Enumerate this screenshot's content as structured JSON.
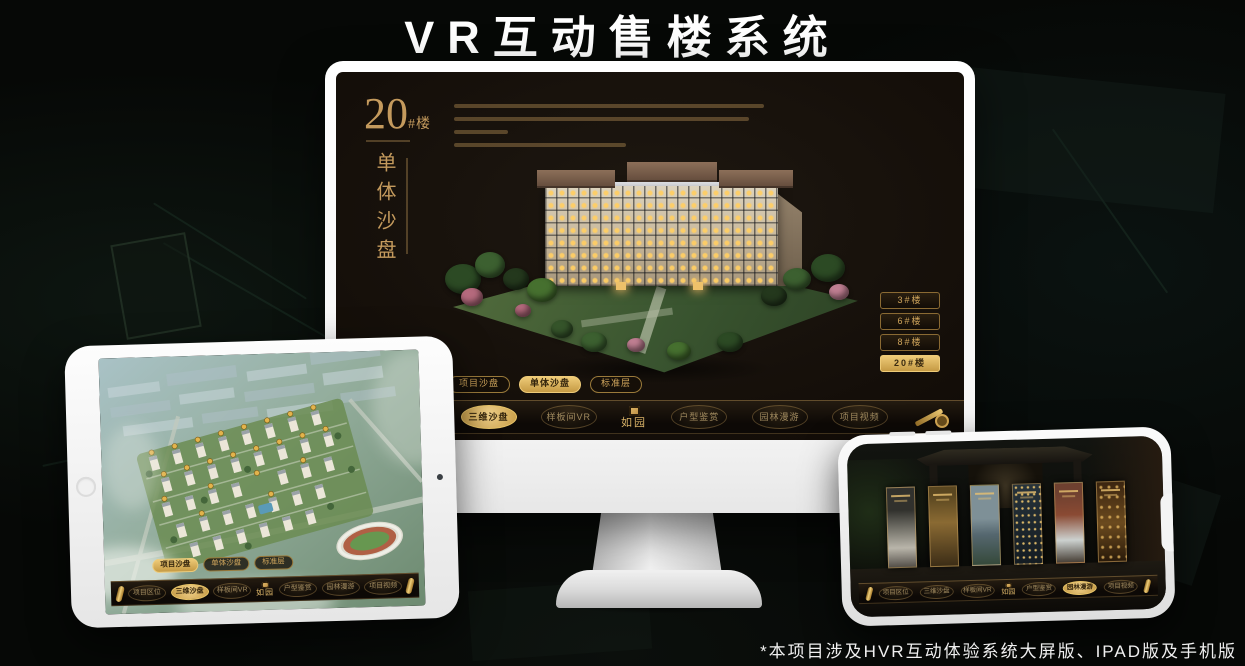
{
  "title": "VR互动售楼系统",
  "footnote": "*本项目涉及HVR互动体验系统大屏版、IPAD版及手机版",
  "colors": {
    "gold": "#c9a15f",
    "gold_bright": "#eecb78",
    "screen_bg": "#15100b",
    "page_bg": "#060806",
    "device_white": "#f6f6f6"
  },
  "monitor": {
    "headline_number": "20",
    "headline_unit": "#楼",
    "headline_subtitle": "单体沙盘",
    "floor_buttons": [
      {
        "label": "3#楼",
        "active": false
      },
      {
        "label": "6#楼",
        "active": false
      },
      {
        "label": "8#楼",
        "active": false
      },
      {
        "label": "20#楼",
        "active": true
      }
    ],
    "mode_tabs": [
      {
        "label": "项目沙盘",
        "active": false
      },
      {
        "label": "单体沙盘",
        "active": true
      },
      {
        "label": "标准层",
        "active": false
      }
    ],
    "nav_items": [
      {
        "label": "项目区位",
        "active": false
      },
      {
        "label": "三维沙盘",
        "active": true
      },
      {
        "label": "样板间VR",
        "active": false
      },
      {
        "label": "户型鉴赏",
        "active": false
      },
      {
        "label": "园林漫游",
        "active": false
      },
      {
        "label": "项目视频",
        "active": false
      }
    ],
    "logo": "如园"
  },
  "ipad": {
    "mode_tabs": [
      {
        "label": "项目沙盘",
        "active": true
      },
      {
        "label": "单体沙盘",
        "active": false
      },
      {
        "label": "标准层",
        "active": false
      }
    ],
    "nav_items": [
      {
        "label": "项目区位",
        "active": false
      },
      {
        "label": "三维沙盘",
        "active": true
      },
      {
        "label": "样板间VR",
        "active": false
      },
      {
        "label": "户型鉴赏",
        "active": false
      },
      {
        "label": "园林漫游",
        "active": false
      },
      {
        "label": "项目视频",
        "active": false
      }
    ],
    "logo": "如园"
  },
  "phone": {
    "nav_items": [
      {
        "label": "项目区位",
        "active": false
      },
      {
        "label": "三维沙盘",
        "active": false
      },
      {
        "label": "样板间VR",
        "active": false
      },
      {
        "label": "户型鉴赏",
        "active": false
      },
      {
        "label": "园林漫游",
        "active": true
      },
      {
        "label": "项目视频",
        "active": false
      }
    ],
    "logo": "如园"
  }
}
